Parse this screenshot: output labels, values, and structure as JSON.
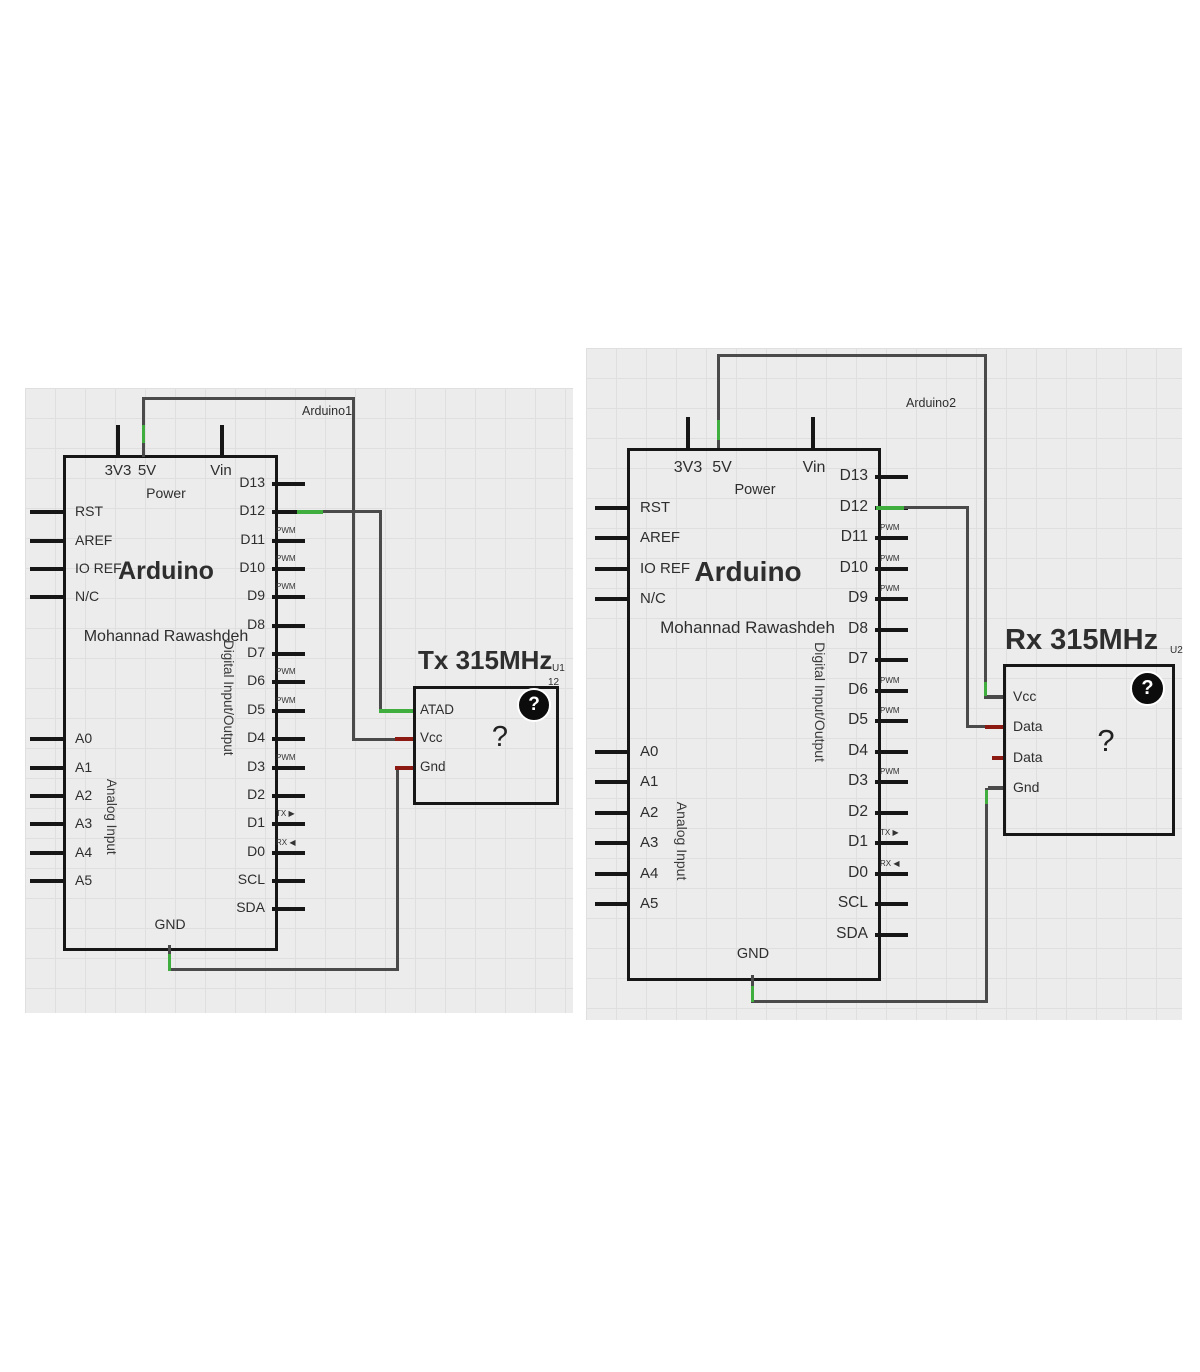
{
  "colors": {
    "wire": "#4a4a4a",
    "stub": "#161616",
    "green": "#3fae3f",
    "red": "#8c1a12",
    "text": "#2e2e2e"
  },
  "diagrams": [
    {
      "net_label": "Arduino1",
      "arduino": {
        "title": "Arduino",
        "subtitle": "Mohannad Rawashdeh",
        "power_group_label": "Power",
        "top_pins": [
          "3V3",
          "5V",
          "Vin"
        ],
        "left_pins": [
          "RST",
          "AREF",
          "IO REF",
          "N/C"
        ],
        "analog_group_label": "Analog Input",
        "analog_pins": [
          "A0",
          "A1",
          "A2",
          "A3",
          "A4",
          "A5"
        ],
        "digital_group_label": "Digital Input/Output",
        "right_pins": [
          {
            "label": "D13",
            "tag": ""
          },
          {
            "label": "D12",
            "tag": ""
          },
          {
            "label": "D11",
            "tag": "PWM"
          },
          {
            "label": "D10",
            "tag": "PWM"
          },
          {
            "label": "D9",
            "tag": "PWM"
          },
          {
            "label": "D8",
            "tag": ""
          },
          {
            "label": "D7",
            "tag": ""
          },
          {
            "label": "D6",
            "tag": "PWM"
          },
          {
            "label": "D5",
            "tag": "PWM"
          },
          {
            "label": "D4",
            "tag": ""
          },
          {
            "label": "D3",
            "tag": "PWM"
          },
          {
            "label": "D2",
            "tag": ""
          },
          {
            "label": "D1",
            "tag": "TX ▶"
          },
          {
            "label": "D0",
            "tag": "RX ◀"
          },
          {
            "label": "SCL",
            "tag": ""
          },
          {
            "label": "SDA",
            "tag": ""
          }
        ],
        "bottom_pin": "GND"
      },
      "module": {
        "title": "Tx 315MHz",
        "designator": "U1",
        "designator2": "12",
        "pins": [
          {
            "label": "ATAD",
            "color": "green"
          },
          {
            "label": "Vcc",
            "color": "red"
          },
          {
            "label": "Gnd",
            "color": "red"
          }
        ],
        "body_glyph": "?",
        "help_icon": "?"
      }
    },
    {
      "net_label": "Arduino2",
      "arduino": {
        "title": "Arduino",
        "subtitle": "Mohannad Rawashdeh",
        "power_group_label": "Power",
        "top_pins": [
          "3V3",
          "5V",
          "Vin"
        ],
        "left_pins": [
          "RST",
          "AREF",
          "IO REF",
          "N/C"
        ],
        "analog_group_label": "Analog Input",
        "analog_pins": [
          "A0",
          "A1",
          "A2",
          "A3",
          "A4",
          "A5"
        ],
        "digital_group_label": "Digital Input/Output",
        "right_pins": [
          {
            "label": "D13",
            "tag": ""
          },
          {
            "label": "D12",
            "tag": ""
          },
          {
            "label": "D11",
            "tag": "PWM"
          },
          {
            "label": "D10",
            "tag": "PWM"
          },
          {
            "label": "D9",
            "tag": "PWM"
          },
          {
            "label": "D8",
            "tag": ""
          },
          {
            "label": "D7",
            "tag": ""
          },
          {
            "label": "D6",
            "tag": "PWM"
          },
          {
            "label": "D5",
            "tag": "PWM"
          },
          {
            "label": "D4",
            "tag": ""
          },
          {
            "label": "D3",
            "tag": "PWM"
          },
          {
            "label": "D2",
            "tag": ""
          },
          {
            "label": "D1",
            "tag": "TX ▶"
          },
          {
            "label": "D0",
            "tag": "RX ◀"
          },
          {
            "label": "SCL",
            "tag": ""
          },
          {
            "label": "SDA",
            "tag": ""
          }
        ],
        "bottom_pin": "GND"
      },
      "module": {
        "title": "Rx 315MHz",
        "designator": "U2",
        "pins": [
          {
            "label": "Vcc",
            "color": "dark"
          },
          {
            "label": "Data",
            "color": "red"
          },
          {
            "label": "Data",
            "color": "red"
          },
          {
            "label": "Gnd",
            "color": "dark"
          }
        ],
        "body_glyph": "?",
        "help_icon": "?"
      }
    }
  ]
}
